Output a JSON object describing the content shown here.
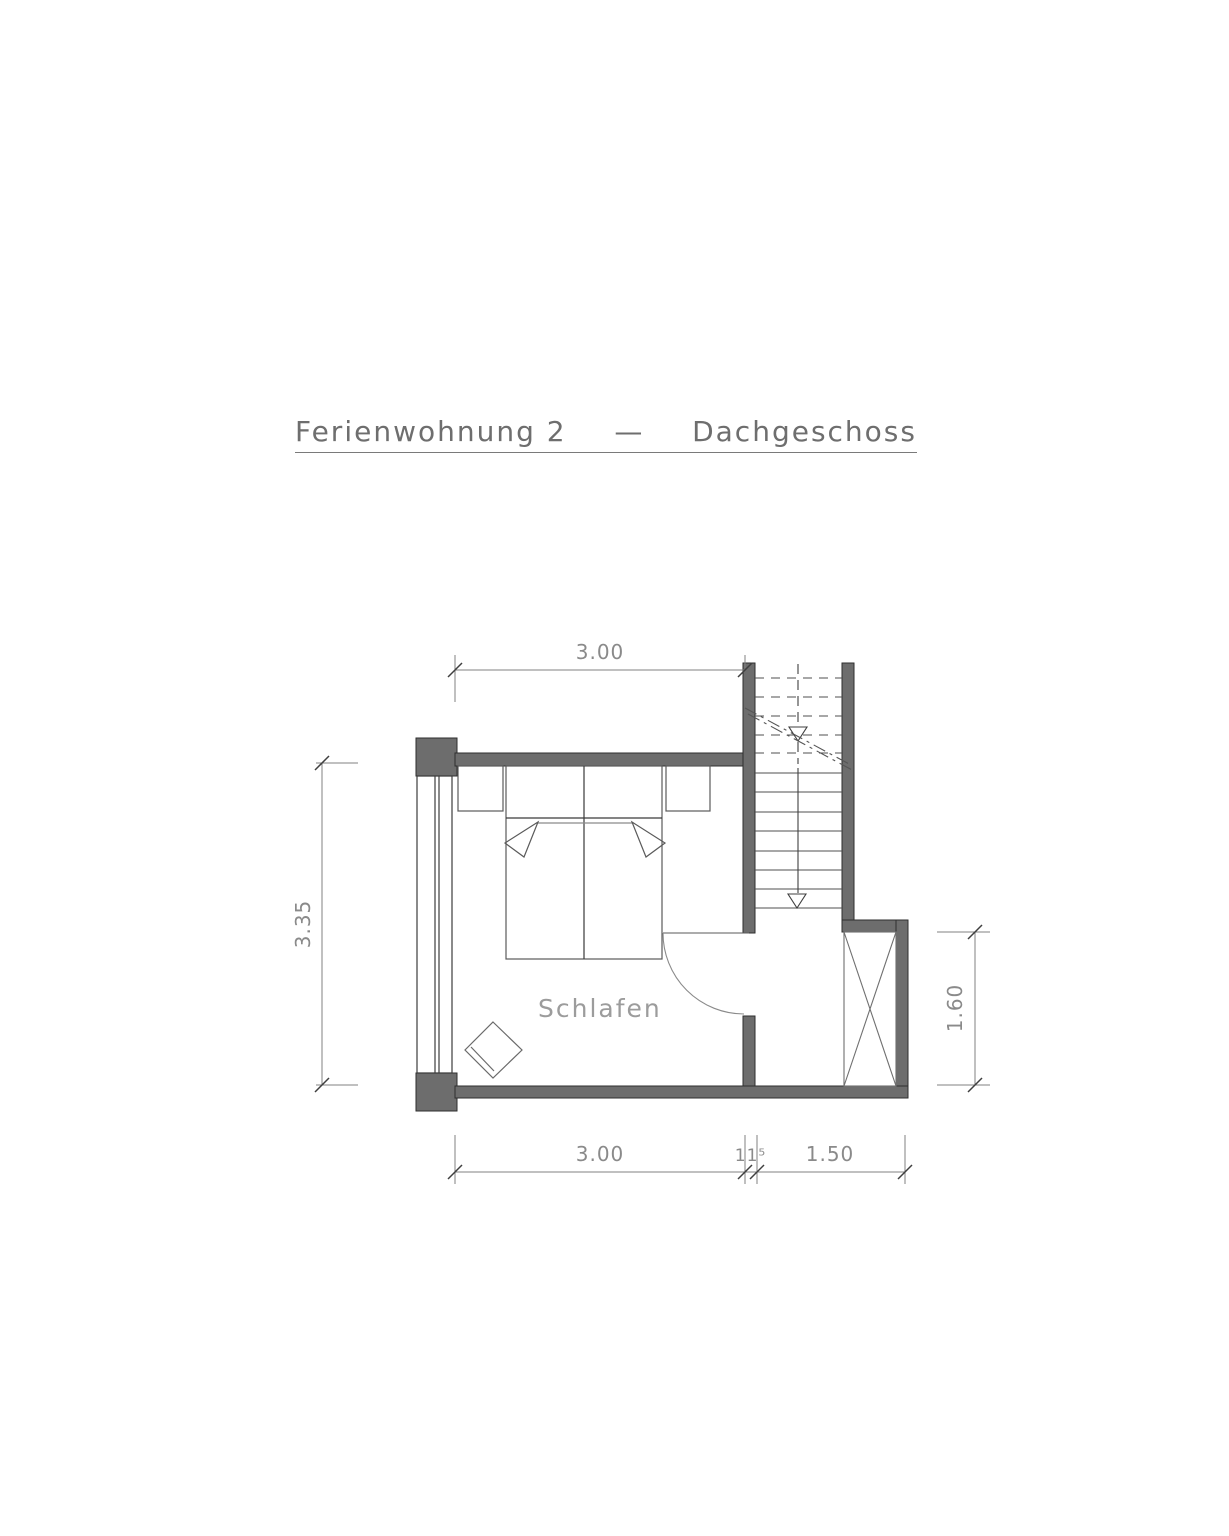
{
  "title": {
    "part1": "Ferienwohnung 2",
    "separator": "—",
    "part2": "Dachgeschoss"
  },
  "room_labels": {
    "bedroom": "Schlafen"
  },
  "dimensions": {
    "top_width": "3.00",
    "left_height": "3.35",
    "right_height": "1.60",
    "bottom_room_width": "3.00",
    "bottom_wall_thickness": "11⁵",
    "bottom_hall_width": "1.50"
  },
  "colors": {
    "background": "#ffffff",
    "wall_fill": "#6d6d6d",
    "wall_outline": "#2e2e2e",
    "thin_line": "#555555",
    "dimension_line": "#808080",
    "text_gray": "#8a8a8a"
  }
}
